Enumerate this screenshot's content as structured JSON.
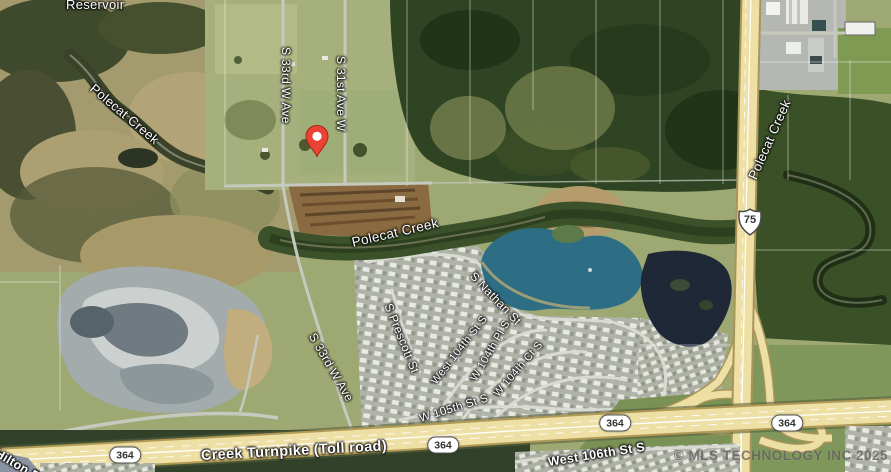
{
  "map": {
    "watermark": "© MLS TECHNOLOGY INC 2025",
    "labels": {
      "reservoir": "Reservoir",
      "polecat_creek_nw": "Polecat Creek",
      "polecat_creek_center": "Polecat Creek",
      "polecat_creek_east": "Polecat Creek",
      "s_33rd_w_ave_north": "S 33rd W Ave",
      "s_31st_ave_w": "S 31st Ave W",
      "s_33rd_w_ave_south": "S 33rd W Ave",
      "s_prescott_st": "S Prescott St",
      "s_nathan_st": "S Nathan St",
      "west_104th_st_s": "West 104th St S",
      "w_104th_pl_s": "W 104th Pl S",
      "w_104th_ct_s": "W 104th Ct S",
      "w_105th_st_s": "W 105th St S",
      "west_106th_st_s": "West 106th St S",
      "creek_turnpike": "Creek Turnpike (Toll road)",
      "hilton_rd": "Hilton Rd"
    },
    "shields": {
      "turnpike": "364",
      "us_highway": "75"
    },
    "colors": {
      "pin_red": "#EA4335",
      "label_text": "#ffffff",
      "shield_bg": "#ffffff",
      "lake": "#2e6e84",
      "highway": "#eedfa4"
    }
  }
}
